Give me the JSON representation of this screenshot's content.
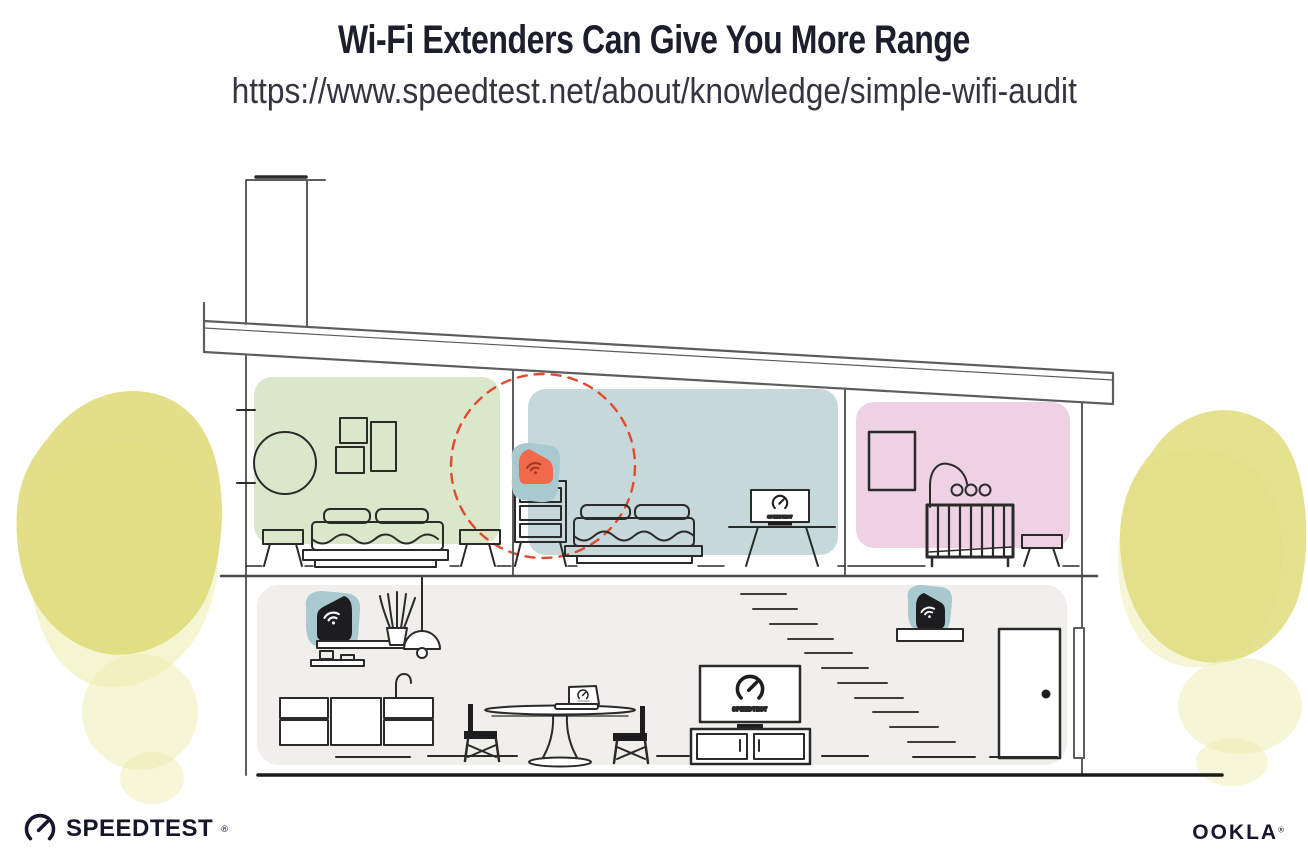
{
  "header": {
    "title": "Wi-Fi Extenders Can Give You More Range",
    "url": "https://www.speedtest.net/about/knowledge/simple-wifi-audit"
  },
  "tv": {
    "brand_label": "SPEEDTEST"
  },
  "footer": {
    "speedtest_label": "SPEEDTEST",
    "speedtest_reg": "®",
    "ookla_label": "OOKLA",
    "ookla_reg": "®"
  },
  "colors": {
    "room_green": "#dbe7ca",
    "room_blue": "#c6d8da",
    "room_pink": "#eed2e3",
    "floor_gray": "#f0efec",
    "tree_yellow": "#dfdc7b",
    "tree_yellow_light": "#edecab",
    "extender_teal": "#a7c9cf",
    "extender_orange": "#f2684a",
    "wifi_dark": "#9c3a1e",
    "device_black": "#1d1d1f",
    "range_dashed_red": "#e14a2e",
    "structure_gray": "#5d5c60",
    "ink": "#1c1e2c"
  }
}
